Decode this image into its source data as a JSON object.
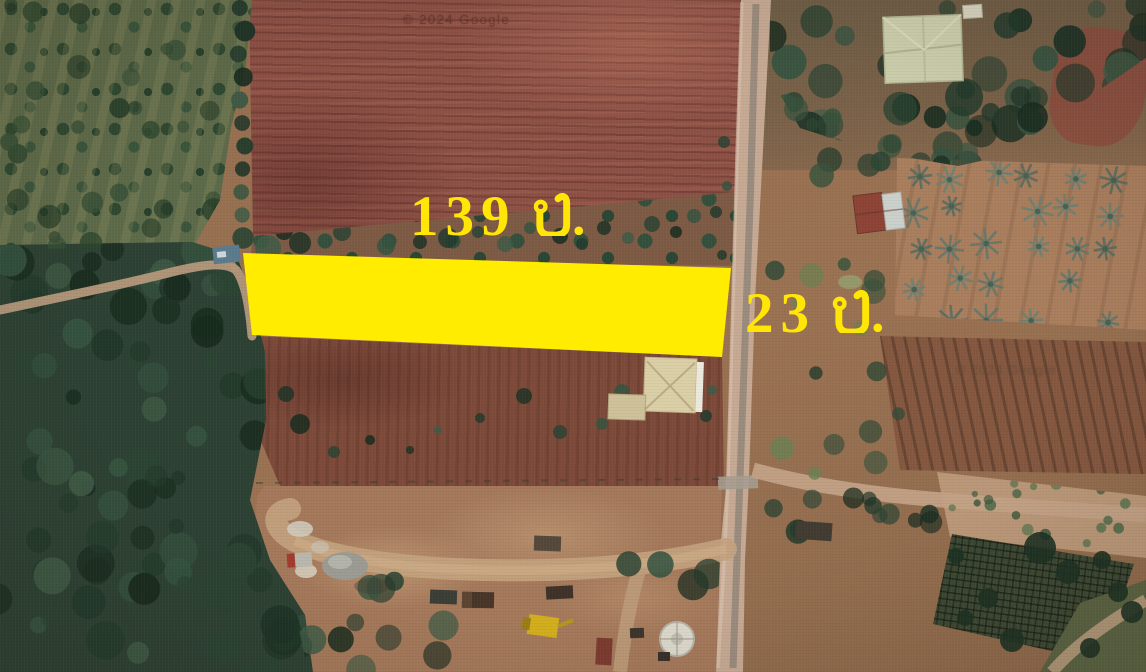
{
  "annotations": {
    "width_label": "139 ม.",
    "width_value": "139",
    "depth_label": "23 ม.",
    "depth_value": "23",
    "unit_abbrev": "ม.",
    "highlight_color": "#FFEC00",
    "label_color": "#FFE606"
  },
  "watermarks": [
    {
      "text": "© 2024 Google"
    },
    {
      "text": "© 2024 Google"
    }
  ]
}
